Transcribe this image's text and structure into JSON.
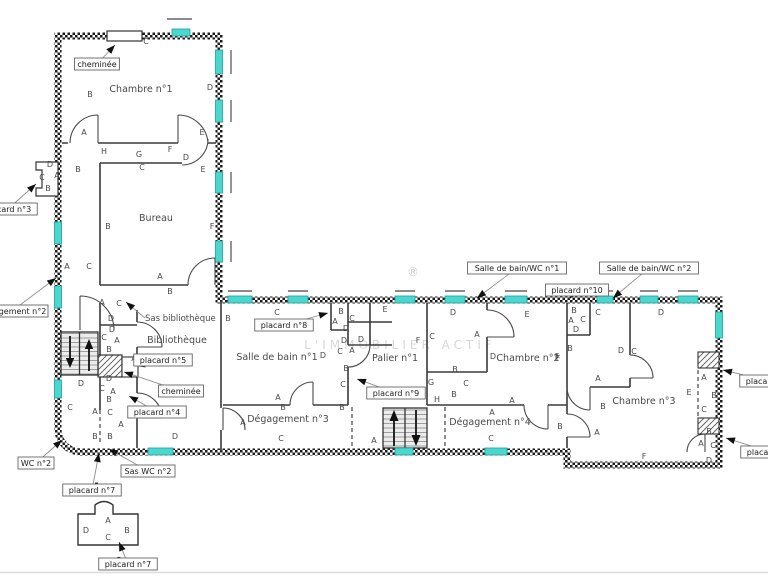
{
  "watermark": {
    "text": "L'IMMOBILIER ACTIF",
    "symbol": "®"
  },
  "colors": {
    "window": "#49d7cf",
    "window_border": "#1f9e98",
    "wall": "#1b1b1b",
    "interior_wall": "#3a3a3a",
    "annotation": "#4a4a4a",
    "leader": "#8f8f8f"
  },
  "rooms": [
    {
      "label": "Chambre n°1",
      "x": 141,
      "y": 92
    },
    {
      "label": "Bureau",
      "x": 156,
      "y": 221
    },
    {
      "label": "Bibliothèque",
      "x": 177,
      "y": 343
    },
    {
      "label": "Salle de bain n°1",
      "x": 277,
      "y": 360
    },
    {
      "label": "Dégagement n°3",
      "x": 288,
      "y": 422
    },
    {
      "label": "Palier n°1",
      "x": 395,
      "y": 361
    },
    {
      "label": "Chambre n°2",
      "x": 528,
      "y": 361
    },
    {
      "label": "Dégagement n°4",
      "x": 490,
      "y": 425
    },
    {
      "label": "Chambre n°3",
      "x": 644,
      "y": 404
    }
  ],
  "callouts": [
    {
      "text": "cheminée",
      "x": 97,
      "y": 64,
      "tx": 115,
      "ty": 45,
      "boxed": true
    },
    {
      "text": "placard n°3",
      "x": 8,
      "y": 209,
      "tx": 36,
      "ty": 184,
      "boxed": true
    },
    {
      "text": "Dégagement n°2",
      "x": 12,
      "y": 311,
      "tx": 56,
      "ty": 278,
      "boxed": true
    },
    {
      "text": "Sas bibliothèque",
      "x": 145,
      "y": 318,
      "tx": 126,
      "ty": 302,
      "boxed": false
    },
    {
      "text": "Salle de bain/WC n°1",
      "x": 517,
      "y": 268,
      "tx": 477,
      "ty": 298,
      "boxed": true
    },
    {
      "text": "placard n°10",
      "x": 577,
      "y": 290,
      "tx": 569,
      "ty": 299,
      "boxed": true
    },
    {
      "text": "Salle de bain/WC n°2",
      "x": 649,
      "y": 268,
      "tx": 613,
      "ty": 298,
      "boxed": true
    },
    {
      "text": "placard n°8",
      "x": 284,
      "y": 325,
      "tx": 328,
      "ty": 313,
      "boxed": true
    },
    {
      "text": "placard n°5",
      "x": 163,
      "y": 360,
      "tx": 136,
      "ty": 366,
      "boxed": true
    },
    {
      "text": "cheminée",
      "x": 181,
      "y": 391,
      "tx": 124,
      "ty": 372,
      "boxed": true
    },
    {
      "text": "placard n°4",
      "x": 157,
      "y": 412,
      "tx": 129,
      "ty": 396,
      "boxed": true
    },
    {
      "text": "placard n°9",
      "x": 396,
      "y": 393,
      "tx": 357,
      "ty": 379,
      "boxed": true
    },
    {
      "text": "WC n°2",
      "x": 36,
      "y": 463,
      "tx": 62,
      "ty": 440,
      "boxed": true
    },
    {
      "text": "Sas WC n°2",
      "x": 148,
      "y": 471,
      "tx": 109,
      "ty": 449,
      "boxed": true
    },
    {
      "text": "placard n°7",
      "x": 92,
      "y": 490,
      "tx": 99,
      "ty": 453,
      "boxed": true
    },
    {
      "text": "placard n°7",
      "x": 128,
      "y": 564,
      "tx": 119,
      "ty": 542,
      "boxed": true
    },
    {
      "text": "placard n°1",
      "x": 769,
      "y": 381,
      "tx": 723,
      "ty": 370,
      "boxed": true
    },
    {
      "text": "placard n°2",
      "x": 770,
      "y": 452,
      "tx": 726,
      "ty": 438,
      "boxed": true
    }
  ],
  "letters": [
    [
      "B",
      90,
      97
    ],
    [
      "C",
      146,
      44
    ],
    [
      "D",
      210,
      90
    ],
    [
      "A",
      84,
      135
    ],
    [
      "E",
      202,
      135
    ],
    [
      "H",
      104,
      154
    ],
    [
      "G",
      139,
      157
    ],
    [
      "F",
      170,
      152
    ],
    [
      "D",
      186,
      160
    ],
    [
      "C",
      142,
      170
    ],
    [
      "E",
      203,
      172
    ],
    [
      "B",
      78,
      172
    ],
    [
      "B",
      108,
      229
    ],
    [
      "F",
      212,
      229
    ],
    [
      "A",
      67,
      269
    ],
    [
      "C",
      89,
      269
    ],
    [
      "A",
      160,
      279
    ],
    [
      "B",
      170,
      294
    ],
    [
      "D",
      50,
      167
    ],
    [
      "C",
      42,
      180
    ],
    [
      "A",
      57,
      178
    ],
    [
      "B",
      48,
      191
    ],
    [
      "A",
      102,
      305
    ],
    [
      "C",
      119,
      306
    ],
    [
      "D",
      111,
      321
    ],
    [
      "D",
      112,
      332
    ],
    [
      "C",
      104,
      340
    ],
    [
      "A",
      117,
      343
    ],
    [
      "B",
      109,
      352
    ],
    [
      "A",
      134,
      361
    ],
    [
      "D",
      81,
      386
    ],
    [
      "D",
      109,
      381
    ],
    [
      "C",
      102,
      391
    ],
    [
      "A",
      113,
      394
    ],
    [
      "B",
      109,
      402
    ],
    [
      "C",
      70,
      410
    ],
    [
      "A",
      95,
      414
    ],
    [
      "C",
      110,
      415
    ],
    [
      "A",
      121,
      427
    ],
    [
      "B",
      95,
      439
    ],
    [
      "B",
      110,
      439
    ],
    [
      "D",
      175,
      439
    ],
    [
      "C",
      277,
      315
    ],
    [
      "B",
      228,
      321
    ],
    [
      "D",
      323,
      358
    ],
    [
      "A",
      278,
      400
    ],
    [
      "B",
      283,
      410
    ],
    [
      "A",
      243,
      425
    ],
    [
      "C",
      281,
      441
    ],
    [
      "B",
      341,
      314
    ],
    [
      "A",
      335,
      324
    ],
    [
      "C",
      352,
      321
    ],
    [
      "D",
      346,
      331
    ],
    [
      "D",
      344,
      343
    ],
    [
      "D",
      361,
      342
    ],
    [
      "C",
      340,
      354
    ],
    [
      "A",
      352,
      353
    ],
    [
      "B",
      346,
      371
    ],
    [
      "C",
      343,
      387
    ],
    [
      "B",
      342,
      410
    ],
    [
      "A",
      374,
      443
    ],
    [
      "E",
      385,
      312
    ],
    [
      "D",
      453,
      315
    ],
    [
      "C",
      432,
      339
    ],
    [
      "F",
      418,
      343
    ],
    [
      "A",
      477,
      337
    ],
    [
      "B",
      455,
      372
    ],
    [
      "E",
      527,
      317
    ],
    [
      "D",
      493,
      359
    ],
    [
      "F",
      557,
      359
    ],
    [
      "G",
      431,
      385
    ],
    [
      "C",
      466,
      386
    ],
    [
      "B",
      454,
      397
    ],
    [
      "H",
      437,
      402
    ],
    [
      "A",
      512,
      403
    ],
    [
      "A",
      492,
      415
    ],
    [
      "C",
      491,
      441
    ],
    [
      "B",
      560,
      429
    ],
    [
      "B",
      574,
      313
    ],
    [
      "A",
      571,
      323
    ],
    [
      "C",
      583,
      322
    ],
    [
      "D",
      576,
      332
    ],
    [
      "C",
      598,
      315
    ],
    [
      "D",
      661,
      315
    ],
    [
      "B",
      570,
      351
    ],
    [
      "D",
      621,
      353
    ],
    [
      "C",
      634,
      354
    ],
    [
      "F",
      558,
      361
    ],
    [
      "A",
      598,
      381
    ],
    [
      "B",
      603,
      409
    ],
    [
      "A",
      597,
      435
    ],
    [
      "A",
      704,
      380
    ],
    [
      "E",
      689,
      395
    ],
    [
      "B",
      714,
      398
    ],
    [
      "C",
      704,
      412
    ],
    [
      "B",
      709,
      434
    ],
    [
      "A",
      701,
      446
    ],
    [
      "C",
      713,
      448
    ],
    [
      "D",
      709,
      463
    ],
    [
      "F",
      644,
      459
    ],
    [
      "A",
      108,
      523
    ],
    [
      "D",
      86,
      533
    ],
    [
      "C",
      108,
      540
    ],
    [
      "B",
      127,
      533
    ]
  ],
  "windows": [
    [
      172,
      29,
      18,
      7
    ],
    [
      215.5,
      50,
      7,
      24
    ],
    [
      215.5,
      100,
      7,
      22
    ],
    [
      215.5,
      172,
      7,
      21
    ],
    [
      215.5,
      241,
      7,
      21
    ],
    [
      54.5,
      222,
      7,
      22
    ],
    [
      54.5,
      286,
      7,
      22
    ],
    [
      54.5,
      380,
      7,
      18
    ],
    [
      228,
      296,
      24,
      7
    ],
    [
      288,
      296,
      20,
      7
    ],
    [
      395,
      296,
      20,
      7
    ],
    [
      445,
      296,
      20,
      7
    ],
    [
      505,
      296,
      22,
      7
    ],
    [
      597,
      296,
      16,
      7
    ],
    [
      640,
      296,
      18,
      7
    ],
    [
      678,
      296,
      20,
      7
    ],
    [
      715.5,
      312,
      7,
      26
    ],
    [
      148,
      448,
      25,
      7
    ],
    [
      395,
      448,
      18,
      7
    ],
    [
      485,
      448,
      22,
      7
    ]
  ],
  "lintels": [
    [
      167,
      19,
      192,
      19
    ],
    [
      231,
      50,
      231,
      74
    ],
    [
      231,
      100,
      231,
      122
    ],
    [
      231,
      172,
      231,
      193
    ],
    [
      231,
      241,
      231,
      262
    ],
    [
      228,
      291,
      252,
      291
    ],
    [
      288,
      291,
      308,
      291
    ],
    [
      395,
      291,
      415,
      291
    ],
    [
      445,
      291,
      465,
      291
    ],
    [
      505,
      291,
      527,
      291
    ],
    [
      597,
      291,
      613,
      291
    ],
    [
      640,
      291,
      658,
      291
    ],
    [
      678,
      291,
      698,
      291
    ]
  ]
}
